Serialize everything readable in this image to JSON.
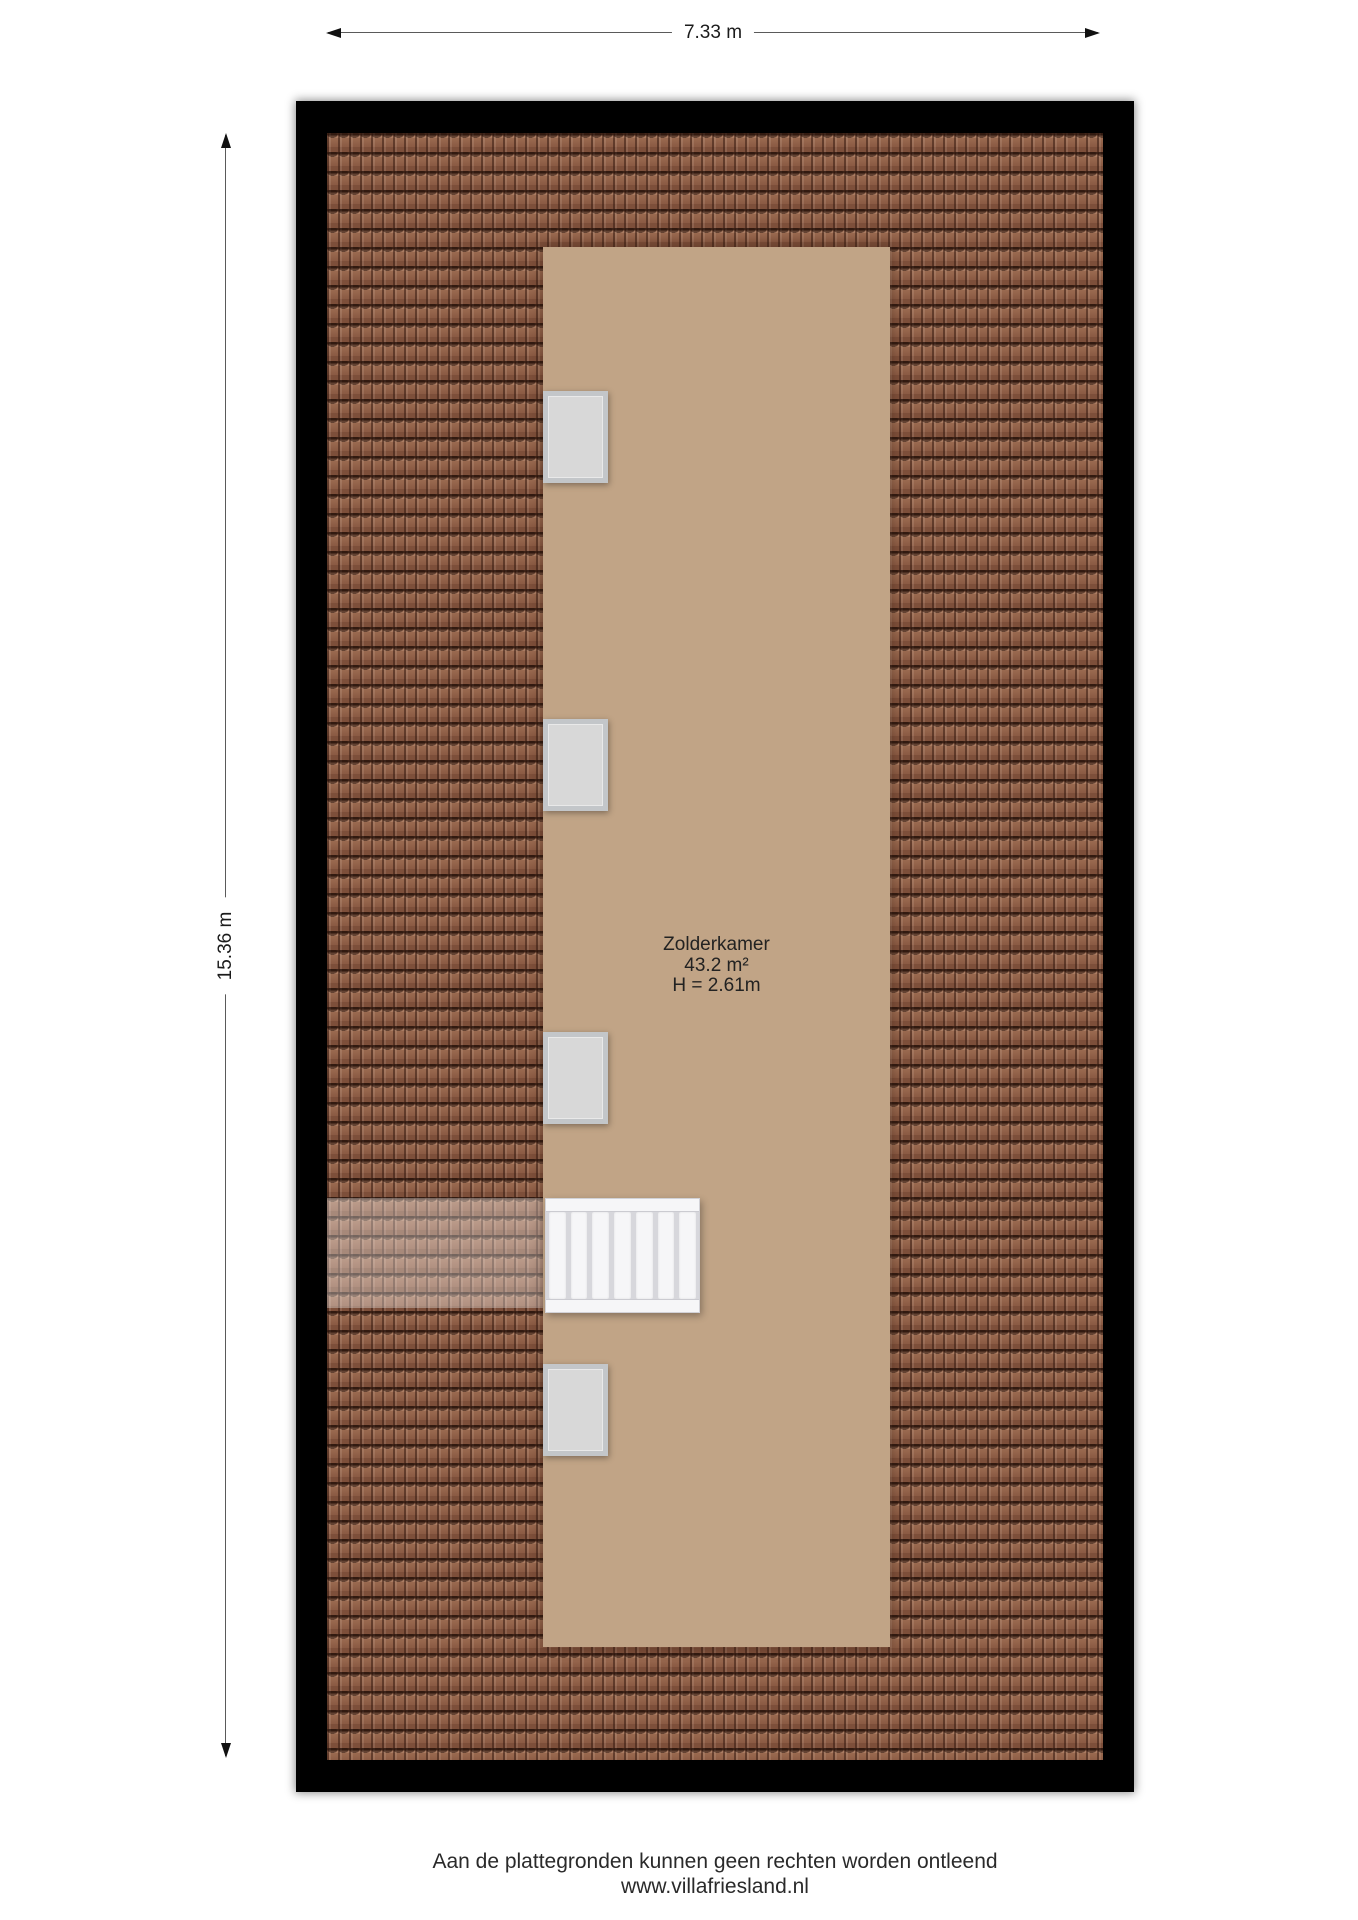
{
  "dimensions": {
    "width_label": "7.33 m",
    "height_label": "15.36 m"
  },
  "room": {
    "name": "Zolderkamer",
    "area": "43.2 m²",
    "ceiling_height": "H = 2.61m"
  },
  "footer": {
    "disclaimer": "Aan de plattegronden kunnen geen rechten worden ontleend",
    "website": "www.villafriesland.nl"
  },
  "elements": {
    "skylight_windows": 4,
    "stair_treads": 7
  },
  "colors": {
    "wall": "#000000",
    "tile_base": "#9a6a50",
    "tile_dark": "#3f2418",
    "room_floor": "#c1a486",
    "window_fill": "#d8d8d8",
    "window_frame": "#c3c6c9",
    "stair_white": "#f6f6f8",
    "dim_line": "#5a5a5a"
  }
}
